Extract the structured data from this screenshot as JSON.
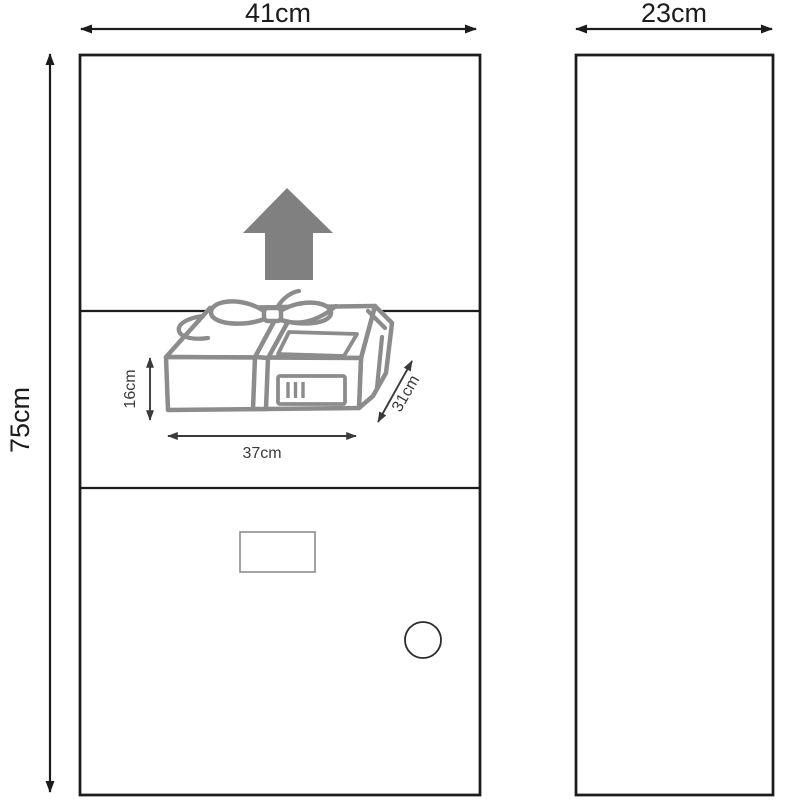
{
  "diagram": {
    "type": "parcel-drop-box-dimension-diagram",
    "views": {
      "front": {
        "width_label": "41cm",
        "height_label": "75cm"
      },
      "side": {
        "width_label": "23cm"
      }
    },
    "parcel": {
      "height_label": "16cm",
      "width_label": "37cm",
      "depth_label": "31cm"
    },
    "colors": {
      "outline": "#1c1c1c",
      "parcel": "#8c8c8c",
      "arrow_fill": "#808080",
      "dim_small": "#3a3a3a"
    }
  }
}
